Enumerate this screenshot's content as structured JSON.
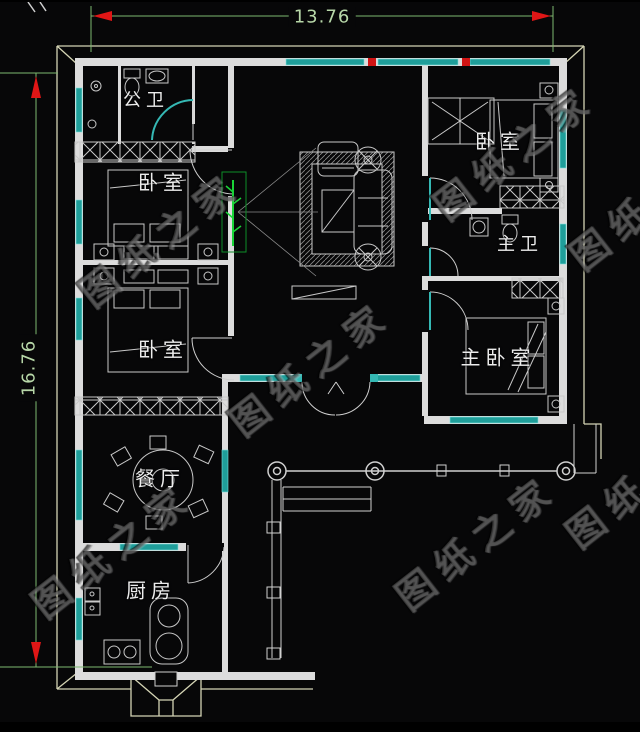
{
  "title": "一层农村自建房平面图 (single-story house floor plan)",
  "dimensions": {
    "top": "13.76",
    "left": "16.76"
  },
  "rooms": {
    "public_bath": "公卫",
    "bedroom_left_1": "卧室",
    "bedroom_left_2": "卧室",
    "bedroom_right": "卧室",
    "master_bath": "主卫",
    "master_bedroom": "主卧室",
    "dining": "餐厅",
    "kitchen": "厨房"
  },
  "watermark": "图纸之家",
  "colors": {
    "background": "#070708",
    "wall": "#dcdcdc",
    "window_teal": "#1f9e9a",
    "roof_outline": "#d4d4b4",
    "dimension_line": "#7cb96f",
    "dimension_text": "#b7d7a8",
    "arrow_red": "#e01616",
    "plant_green": "#1ad438",
    "watermark_gray": "#808080"
  }
}
